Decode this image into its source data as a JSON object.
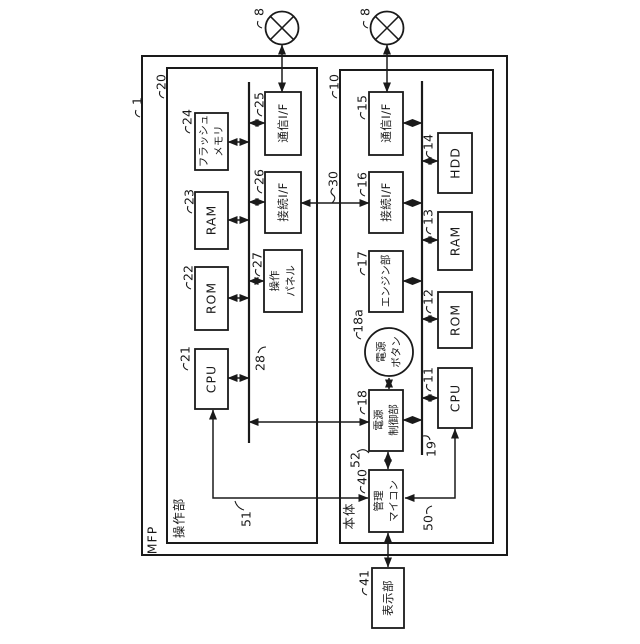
{
  "colors": {
    "line": "#1a1a1a",
    "background": "#ffffff"
  },
  "outer": {
    "label": "MFP",
    "ref": "1"
  },
  "network_nodes": {
    "left_ref": "8",
    "right_ref": "8"
  },
  "operation_unit": {
    "label": "操作部",
    "ref": "20",
    "bus": {
      "ref": "28"
    },
    "cpu": {
      "label": "CPU",
      "ref": "21"
    },
    "rom": {
      "label": "ROM",
      "ref": "22"
    },
    "ram": {
      "label": "RAM",
      "ref": "23"
    },
    "flash_memory": {
      "line1": "フラッシュ",
      "line2": "メモリ",
      "ref": "24"
    },
    "comm_if": {
      "label": "通信I/F",
      "ref": "25"
    },
    "conn_if": {
      "label": "接続I/F",
      "ref": "26"
    },
    "operation_panel": {
      "line1": "操作",
      "line2": "パネル",
      "ref": "27"
    }
  },
  "main_body": {
    "label": "本体",
    "ref": "10",
    "bus": {
      "ref": "19"
    },
    "comm_if": {
      "label": "通信I/F",
      "ref": "15"
    },
    "conn_if": {
      "label": "接続I/F",
      "ref": "16"
    },
    "engine": {
      "label": "エンジン部",
      "ref": "17"
    },
    "power_button": {
      "line1": "電源",
      "line2": "ボタン",
      "ref": "18a"
    },
    "power_control": {
      "line1": "電源",
      "line2": "制御部",
      "ref": "18"
    },
    "management_micon": {
      "line1": "管理",
      "line2": "マイコン",
      "ref": "40"
    },
    "hdd": {
      "label": "HDD",
      "ref": "14"
    },
    "ram": {
      "label": "RAM",
      "ref": "13"
    },
    "rom": {
      "label": "ROM",
      "ref": "12"
    },
    "cpu": {
      "label": "CPU",
      "ref": "11"
    }
  },
  "display_unit": {
    "label": "表示部",
    "ref": "41"
  },
  "links": {
    "if_link_ref": "30",
    "op_cpu_to_mgmt_ref": "51",
    "main_cpu_to_mgmt_ref": "50",
    "power_to_mgmt_ref": "52"
  }
}
